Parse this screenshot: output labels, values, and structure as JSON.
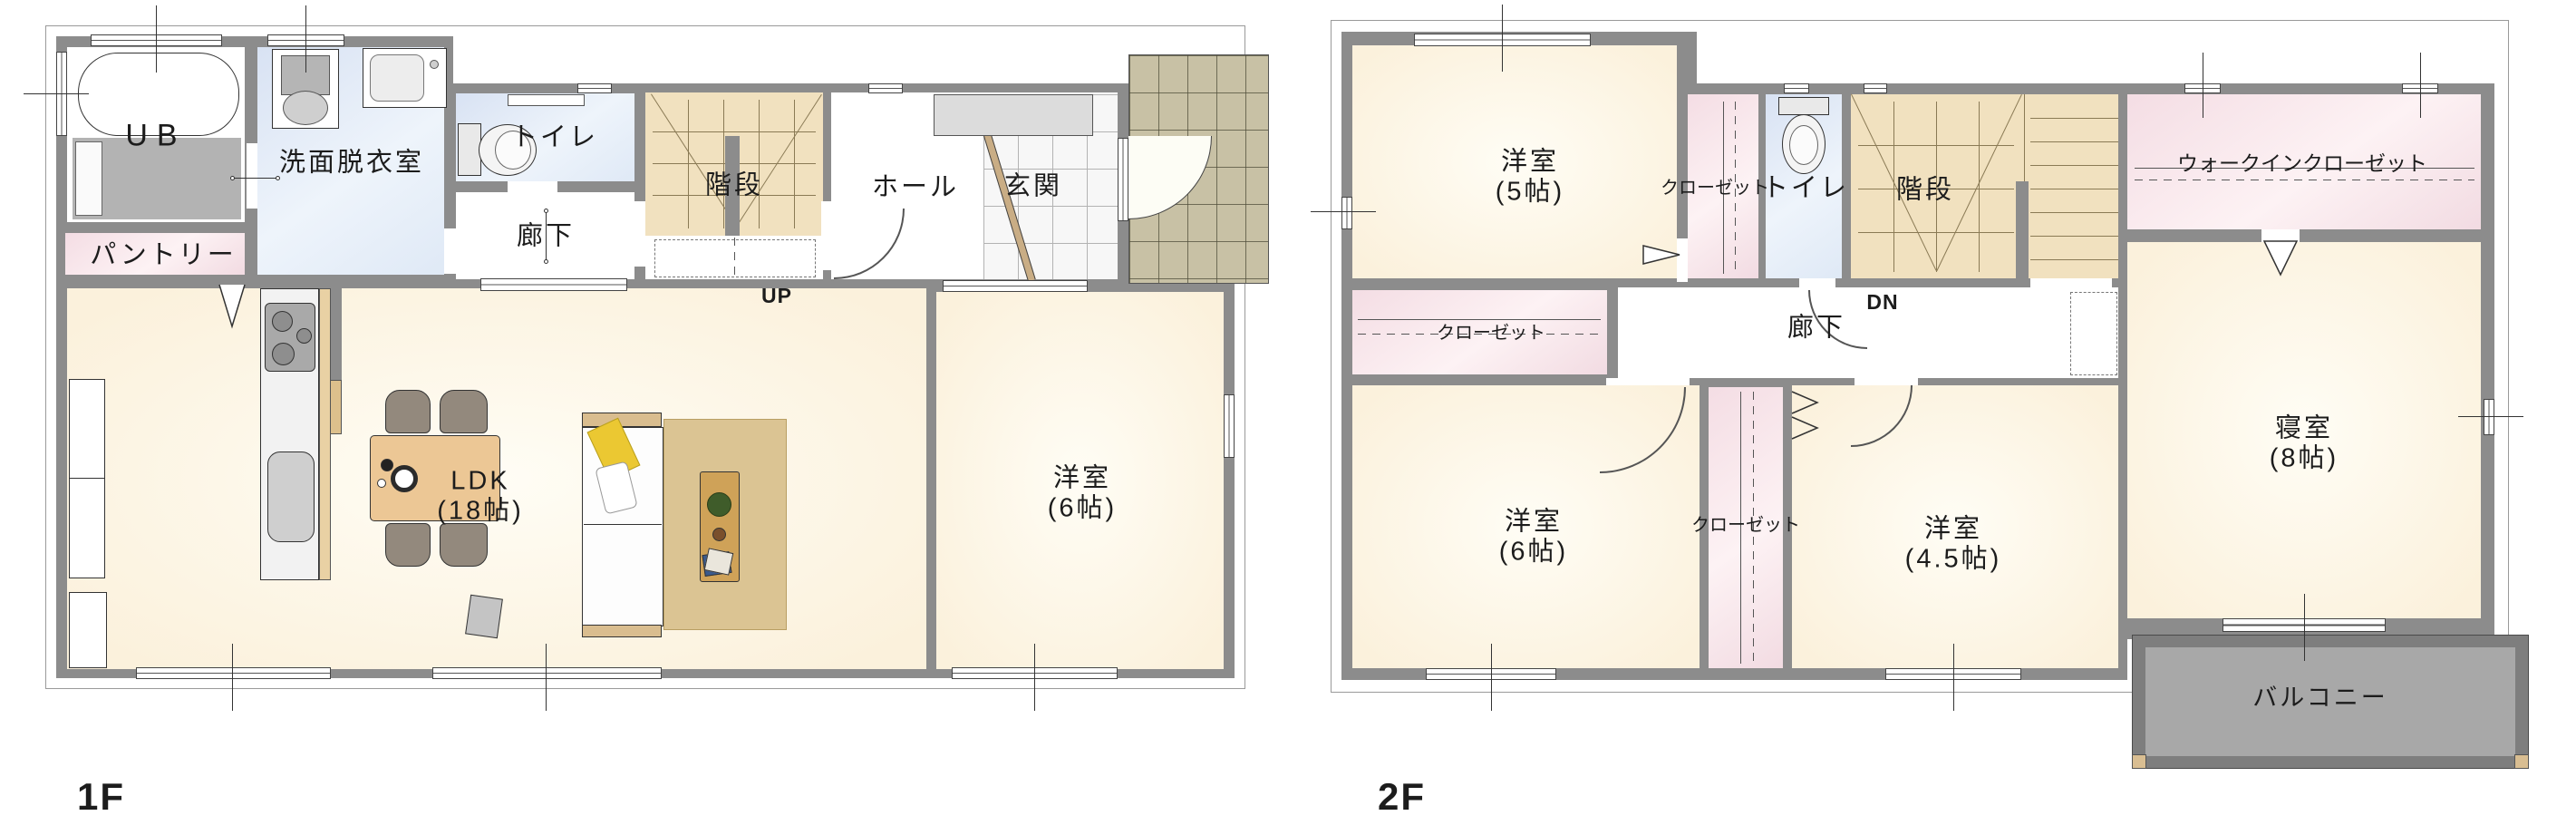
{
  "floor1": {
    "label": "1F",
    "rooms": {
      "ub": "UB",
      "washroom": "洗面脱衣室",
      "toilet": "トイレ",
      "stairs": "階段",
      "hall": "ホール",
      "entrance": "玄関",
      "corridor": "廊下",
      "pantry": "パントリー",
      "up": "UP",
      "ldk": {
        "name": "LDK",
        "size": "(18帖)"
      },
      "bedroom6": {
        "name": "洋室",
        "size": "(6帖)"
      }
    }
  },
  "floor2": {
    "label": "2F",
    "rooms": {
      "room5": {
        "name": "洋室",
        "size": "(5帖)"
      },
      "closet_top": "クローゼット",
      "toilet": "トイレ",
      "stairs": "階段",
      "wic": "ウォークインクローゼット",
      "closet_left": "クローゼット",
      "corridor": "廊下",
      "dn": "DN",
      "room6": {
        "name": "洋室",
        "size": "(6帖)"
      },
      "closet_mid": "クローゼット",
      "room45": {
        "name": "洋室",
        "size": "(4.5帖)"
      },
      "master": {
        "name": "寝室",
        "size": "(8帖)"
      },
      "balcony": "バルコニー"
    }
  },
  "colors": {
    "wall": "#8c8c8c",
    "room_cream": "#fbf1dc",
    "room_blue": "#dfe9f6",
    "room_pink": "#f2dbe2",
    "stairs_tan": "#f1e1bf",
    "porch_tile": "#c8c1a5",
    "balcony_floor": "#a8a8a8"
  }
}
